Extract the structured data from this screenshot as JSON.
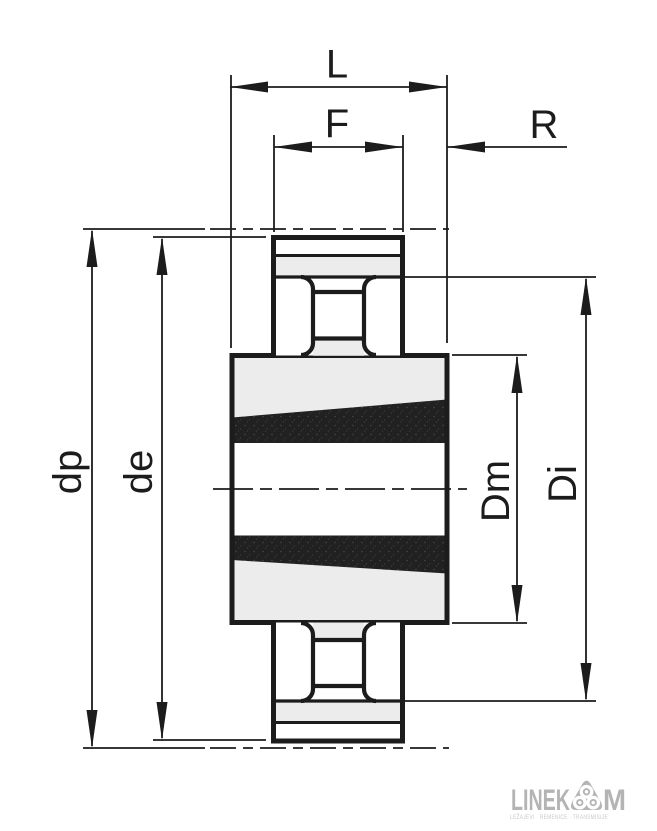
{
  "dims": {
    "L": "L",
    "F": "F",
    "R": "R",
    "dp": "dp",
    "de": "de",
    "Dm": "Dm",
    "Di": "Di"
  },
  "logo": {
    "brand_left": "LINEK",
    "brand_right": "M",
    "tagline": "LEŽAJEVI · REMENICE · TRANSMISIJE"
  },
  "colors": {
    "line": "#1c1c1c",
    "fill_light": "#ececec",
    "fill_dark": "#212121",
    "logo_gray": "#b4b4b4"
  }
}
